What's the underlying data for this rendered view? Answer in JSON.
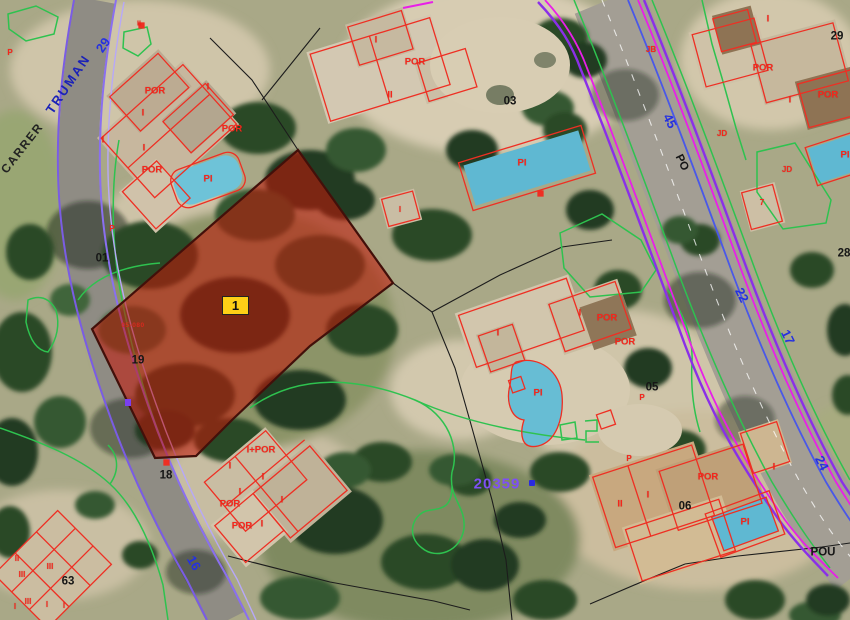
{
  "map": {
    "marker_label": "1",
    "street_carrer": "CARRER",
    "street_truman": "TRUMAN",
    "cadastral_ref": "20359",
    "parcel_code": "05-080",
    "highlight_fill": "#c41407",
    "marker_bg": "#fdd017"
  },
  "labels": {
    "red": [
      {
        "t": "P",
        "x": 10,
        "y": 53,
        "s": 8
      },
      {
        "t": "II",
        "x": 139,
        "y": 24,
        "s": 7
      },
      {
        "t": "POR",
        "x": 155,
        "y": 91
      },
      {
        "t": "I",
        "x": 208,
        "y": 87
      },
      {
        "t": "I",
        "x": 143,
        "y": 113
      },
      {
        "t": "POR",
        "x": 232,
        "y": 129
      },
      {
        "t": "I",
        "x": 103,
        "y": 140
      },
      {
        "t": "I",
        "x": 144,
        "y": 148
      },
      {
        "t": "POR",
        "x": 152,
        "y": 170
      },
      {
        "t": "PI",
        "x": 208,
        "y": 179
      },
      {
        "t": "P",
        "x": 112,
        "y": 229,
        "s": 8
      },
      {
        "t": "I",
        "x": 376,
        "y": 40
      },
      {
        "t": "POR",
        "x": 415,
        "y": 62
      },
      {
        "t": "II",
        "x": 390,
        "y": 95
      },
      {
        "t": "I",
        "x": 400,
        "y": 210,
        "s": 8
      },
      {
        "t": "PI",
        "x": 522,
        "y": 163
      },
      {
        "t": "JB",
        "x": 651,
        "y": 50,
        "s": 8
      },
      {
        "t": "I",
        "x": 768,
        "y": 19
      },
      {
        "t": "POR",
        "x": 763,
        "y": 68
      },
      {
        "t": "I",
        "x": 790,
        "y": 100
      },
      {
        "t": "POR",
        "x": 828,
        "y": 95
      },
      {
        "t": "JD",
        "x": 722,
        "y": 134,
        "s": 8
      },
      {
        "t": "PI",
        "x": 845,
        "y": 155
      },
      {
        "t": "JD",
        "x": 787,
        "y": 170,
        "s": 8
      },
      {
        "t": "7",
        "x": 762,
        "y": 203,
        "s": 8
      },
      {
        "t": "I",
        "x": 498,
        "y": 333
      },
      {
        "t": "I",
        "x": 580,
        "y": 313
      },
      {
        "t": "POR",
        "x": 607,
        "y": 318
      },
      {
        "t": "POR",
        "x": 625,
        "y": 342
      },
      {
        "t": "PI",
        "x": 538,
        "y": 393
      },
      {
        "t": "P",
        "x": 642,
        "y": 398,
        "s": 8
      },
      {
        "t": "I+POR",
        "x": 261,
        "y": 450
      },
      {
        "t": "I",
        "x": 230,
        "y": 466
      },
      {
        "t": "I",
        "x": 263,
        "y": 477
      },
      {
        "t": "I",
        "x": 240,
        "y": 492
      },
      {
        "t": "POR",
        "x": 230,
        "y": 504
      },
      {
        "t": "I",
        "x": 282,
        "y": 500
      },
      {
        "t": "POR",
        "x": 242,
        "y": 526
      },
      {
        "t": "I",
        "x": 262,
        "y": 524
      },
      {
        "t": "P",
        "x": 629,
        "y": 459,
        "s": 8
      },
      {
        "t": "I",
        "x": 774,
        "y": 467
      },
      {
        "t": "POR",
        "x": 708,
        "y": 477
      },
      {
        "t": "I",
        "x": 648,
        "y": 495
      },
      {
        "t": "II",
        "x": 620,
        "y": 504
      },
      {
        "t": "PI",
        "x": 745,
        "y": 522
      },
      {
        "t": "II",
        "x": 17,
        "y": 559,
        "s": 8
      },
      {
        "t": "III",
        "x": 50,
        "y": 567,
        "s": 8
      },
      {
        "t": "III",
        "x": 22,
        "y": 575,
        "s": 8
      },
      {
        "t": "III",
        "x": 28,
        "y": 602,
        "s": 8
      },
      {
        "t": "I",
        "x": 15,
        "y": 607,
        "s": 8
      },
      {
        "t": "I",
        "x": 47,
        "y": 605,
        "s": 8
      },
      {
        "t": "I",
        "x": 64,
        "y": 606,
        "s": 8
      }
    ],
    "black": [
      {
        "t": "01",
        "x": 102,
        "y": 259
      },
      {
        "t": "03",
        "x": 510,
        "y": 102
      },
      {
        "t": "05",
        "x": 652,
        "y": 388
      },
      {
        "t": "06",
        "x": 685,
        "y": 507
      },
      {
        "t": "18",
        "x": 166,
        "y": 476
      },
      {
        "t": "19",
        "x": 138,
        "y": 361
      },
      {
        "t": "28",
        "x": 844,
        "y": 254
      },
      {
        "t": "29",
        "x": 837,
        "y": 37
      },
      {
        "t": "63",
        "x": 68,
        "y": 582
      },
      {
        "t": "POU",
        "x": 823,
        "y": 553
      },
      {
        "t": "PO",
        "x": 681,
        "y": 163,
        "r": 64
      }
    ],
    "blue": [
      {
        "t": "29",
        "x": 103,
        "y": 45,
        "r": -56
      },
      {
        "t": "45",
        "x": 670,
        "y": 121,
        "r": 63
      },
      {
        "t": "22",
        "x": 742,
        "y": 295,
        "r": 64
      },
      {
        "t": "17",
        "x": 788,
        "y": 337,
        "r": 64
      },
      {
        "t": "24",
        "x": 822,
        "y": 463,
        "r": 64
      },
      {
        "t": "16",
        "x": 194,
        "y": 563,
        "r": 60
      }
    ]
  }
}
